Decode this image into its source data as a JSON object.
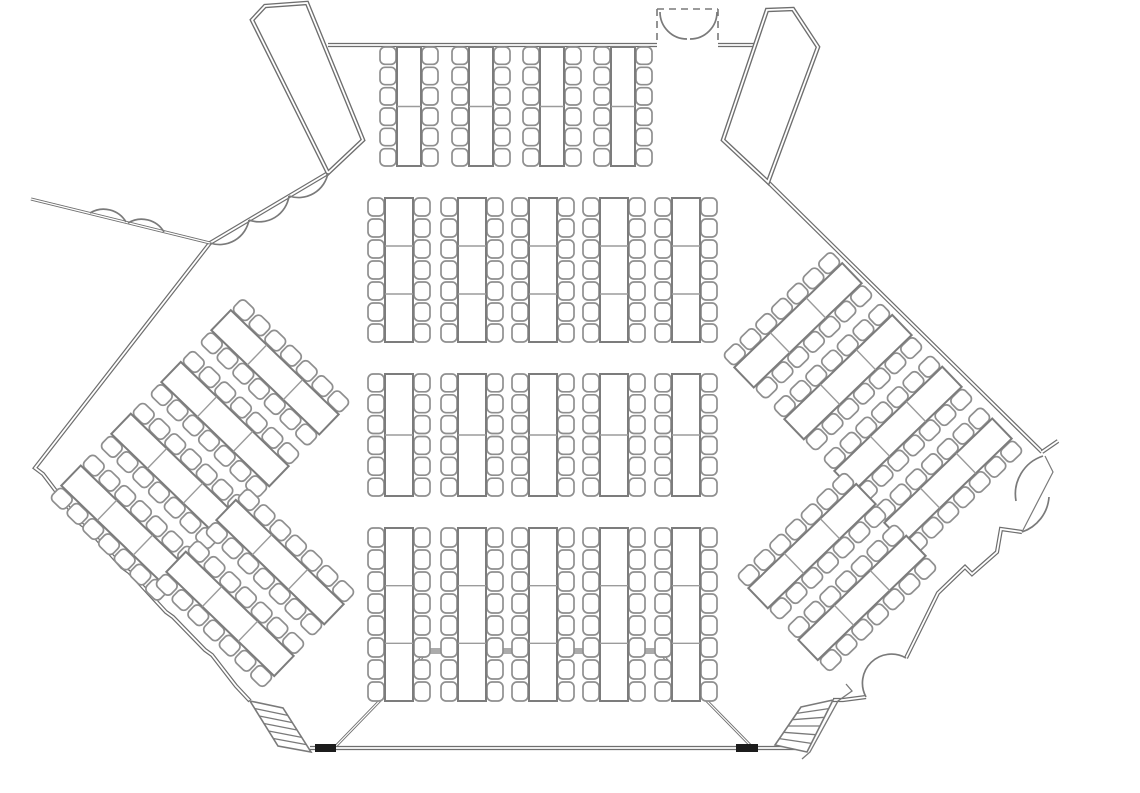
{
  "document": {
    "title": "Assembly hall floor plan",
    "type": "architectural-floor-plan",
    "visible_text": ""
  },
  "canvas": {
    "width": 1140,
    "height": 793,
    "background": "#ffffff"
  },
  "palette": {
    "wall": "#6e6e6e",
    "door": "#7a7a7a",
    "chair_stroke": "#8f8f8f",
    "table_stroke": "#7c7c7c",
    "table_divider": "#9b9b9b",
    "stage_bar": "#ababab",
    "wall_cap": "#1c1c1c",
    "white": "#ffffff"
  },
  "walls": {
    "double": [
      {
        "name": "north-wall-west",
        "pts": [
          [
            328,
            45
          ],
          [
            657,
            45
          ]
        ]
      },
      {
        "name": "north-wall-east",
        "pts": [
          [
            718,
            45
          ],
          [
            756,
            45
          ]
        ]
      },
      {
        "name": "northwest-wall",
        "pts": [
          [
            328,
            173
          ],
          [
            210,
            243
          ]
        ]
      },
      {
        "name": "west-wall",
        "pts": [
          [
            210,
            243
          ],
          [
            35,
            468
          ],
          [
            43,
            474
          ],
          [
            81,
            524
          ],
          [
            88,
            529
          ],
          [
            122,
            567
          ],
          [
            129,
            572
          ],
          [
            166,
            612
          ],
          [
            173,
            617
          ],
          [
            205,
            650
          ],
          [
            212,
            655
          ],
          [
            236,
            686
          ],
          [
            250,
            701
          ]
        ]
      },
      {
        "name": "northeast-wall",
        "pts": [
          [
            768,
            182
          ],
          [
            1042,
            452
          ]
        ]
      },
      {
        "name": "northeast-stub",
        "pts": [
          [
            1042,
            452
          ],
          [
            1058,
            441
          ]
        ]
      },
      {
        "name": "southeast-wall",
        "pts": [
          [
            1022,
            532
          ],
          [
            1001,
            529
          ],
          [
            997,
            552
          ],
          [
            972,
            574
          ],
          [
            965,
            567
          ],
          [
            938,
            593
          ],
          [
            906,
            658
          ]
        ]
      },
      {
        "name": "southeast-wall-lower",
        "pts": [
          [
            866,
            697
          ],
          [
            843,
            700
          ],
          [
            833,
            700
          ]
        ]
      },
      {
        "name": "south-wall",
        "pts": [
          [
            310,
            748
          ],
          [
            795,
            748
          ]
        ]
      }
    ],
    "thin": [
      {
        "name": "exterior-spur-wall",
        "pts": [
          [
            31,
            199
          ],
          [
            210,
            243
          ]
        ]
      }
    ],
    "caps": [
      {
        "name": "south-wall-cap-west",
        "x": 315,
        "y": 744,
        "w": 21,
        "h": 8
      },
      {
        "name": "south-wall-cap-east",
        "x": 736,
        "y": 744,
        "w": 22,
        "h": 8
      }
    ]
  },
  "vestibules": [
    {
      "name": "northwest-vestibule",
      "pts": [
        [
          252,
          20
        ],
        [
          265,
          6
        ],
        [
          307,
          3
        ],
        [
          363,
          140
        ],
        [
          328,
          173
        ]
      ]
    },
    {
      "name": "northeast-vestibule",
      "pts": [
        [
          767,
          10
        ],
        [
          793,
          9
        ],
        [
          818,
          47
        ],
        [
          768,
          182
        ],
        [
          723,
          140
        ]
      ]
    }
  ],
  "doors": {
    "dashed_frame": [
      [
        [
          657,
          9
        ],
        [
          657,
          45
        ]
      ],
      [
        [
          718,
          9
        ],
        [
          718,
          45
        ]
      ],
      [
        [
          657,
          9
        ],
        [
          718,
          9
        ]
      ]
    ],
    "arcs": [
      {
        "name": "north-door-left-leaf",
        "d": "M 660 12 A 27 27 0 0 0 687 39"
      },
      {
        "name": "north-door-right-leaf",
        "d": "M 717 12 A 27 27 0 0 1 690 39"
      },
      {
        "name": "northwest-door-leaf-1",
        "d": "M 328 173 A 30 30 0 0 1 289 196"
      },
      {
        "name": "northwest-door-leaf-2",
        "d": "M 289 196 A 30 30 0 0 1 249 220"
      },
      {
        "name": "northwest-door-leaf-3",
        "d": "M 249 220 A 30 30 0 0 1 210 243"
      },
      {
        "name": "spur-door-leaf-1",
        "d": "M 90 213 A 26 26 0 0 1 126 222"
      },
      {
        "name": "spur-door-leaf-2",
        "d": "M 128 223 A 26 26 0 0 1 164 232"
      },
      {
        "name": "east-door-upper-leaf",
        "d": "M 1043 456 A 40 40 0 0 0 1016 501"
      },
      {
        "name": "east-door-lower-leaf",
        "d": "M 1022 532 A 40 40 0 0 0 1049 497"
      },
      {
        "name": "southeast-wall-recess",
        "d": "M 906 658 A 29 29 0 0 0 866 697"
      }
    ],
    "chords": [
      {
        "name": "east-door-chord",
        "pts": [
          [
            1045,
            456
          ],
          [
            1053,
            472
          ],
          [
            1022,
            532
          ]
        ]
      }
    ]
  },
  "stage": {
    "name": "stage-platform",
    "front_edge": [
      [
        428,
        651
      ],
      [
        658,
        651
      ]
    ],
    "side_edges": [
      [
        [
          428,
          651
        ],
        [
          335,
          747
        ]
      ],
      [
        [
          658,
          651
        ],
        [
          752,
          747
        ]
      ]
    ]
  },
  "stairs": [
    {
      "name": "southwest-stairs",
      "corners": [
        [
          250,
          701
        ],
        [
          283,
          708
        ],
        [
          311,
          752
        ],
        [
          278,
          746
        ]
      ],
      "steps": 6
    },
    {
      "name": "southeast-stairs",
      "corners": [
        [
          801,
          707
        ],
        [
          833,
          700
        ],
        [
          807,
          752
        ],
        [
          775,
          745
        ]
      ],
      "steps": 6
    }
  ],
  "railings": [
    {
      "name": "southeast-stair-railing",
      "pts": [
        [
          846,
          684
        ],
        [
          852,
          691
        ],
        [
          838,
          701
        ],
        [
          810,
          752
        ],
        [
          802,
          759
        ]
      ]
    }
  ],
  "seating": {
    "style": {
      "chair_width": 16,
      "chair_gap": 3,
      "chair_corner_radius": 5
    },
    "straight_rows": [
      {
        "name": "north-row",
        "y": 47,
        "group_height": 119,
        "chairs_per_side": 6,
        "table_segments": 2,
        "group_width": 58,
        "x_positions": [
          380,
          452,
          523,
          594
        ]
      },
      {
        "name": "middle-row-1",
        "y": 198,
        "group_height": 144,
        "chairs_per_side": 7,
        "table_segments": 3,
        "group_width": 62,
        "x_positions": [
          368,
          441,
          512,
          583,
          655
        ]
      },
      {
        "name": "middle-row-2",
        "y": 374,
        "group_height": 122,
        "chairs_per_side": 6,
        "table_segments": 2,
        "group_width": 62,
        "x_positions": [
          368,
          441,
          512,
          583,
          655
        ]
      },
      {
        "name": "south-row",
        "y": 528,
        "group_height": 173,
        "chairs_per_side": 8,
        "table_segments": 3,
        "group_width": 62,
        "x_positions": [
          368,
          441,
          512,
          583,
          655
        ]
      }
    ],
    "rotated_clusters": [
      {
        "name": "west-large-cluster",
        "cx": 200,
        "cy": 450,
        "angle": -46,
        "groups": 4,
        "group_width": 62,
        "group_height": 150,
        "group_gap": 10,
        "chairs_per_side": 7,
        "table_segments": 3
      },
      {
        "name": "west-small-cluster",
        "cx": 255,
        "cy": 588,
        "angle": -46,
        "groups": 2,
        "group_width": 62,
        "group_height": 150,
        "group_gap": 10,
        "chairs_per_side": 7,
        "table_segments": 3
      },
      {
        "name": "east-large-cluster",
        "cx": 873,
        "cy": 403,
        "angle": 46,
        "groups": 4,
        "group_width": 62,
        "group_height": 150,
        "group_gap": 10,
        "chairs_per_side": 7,
        "table_segments": 3
      },
      {
        "name": "east-small-cluster",
        "cx": 837,
        "cy": 572,
        "angle": 46,
        "groups": 2,
        "group_width": 62,
        "group_height": 150,
        "group_gap": 10,
        "chairs_per_side": 7,
        "table_segments": 3
      }
    ],
    "totals": {
      "table_groups": 31,
      "seats": 426
    }
  }
}
